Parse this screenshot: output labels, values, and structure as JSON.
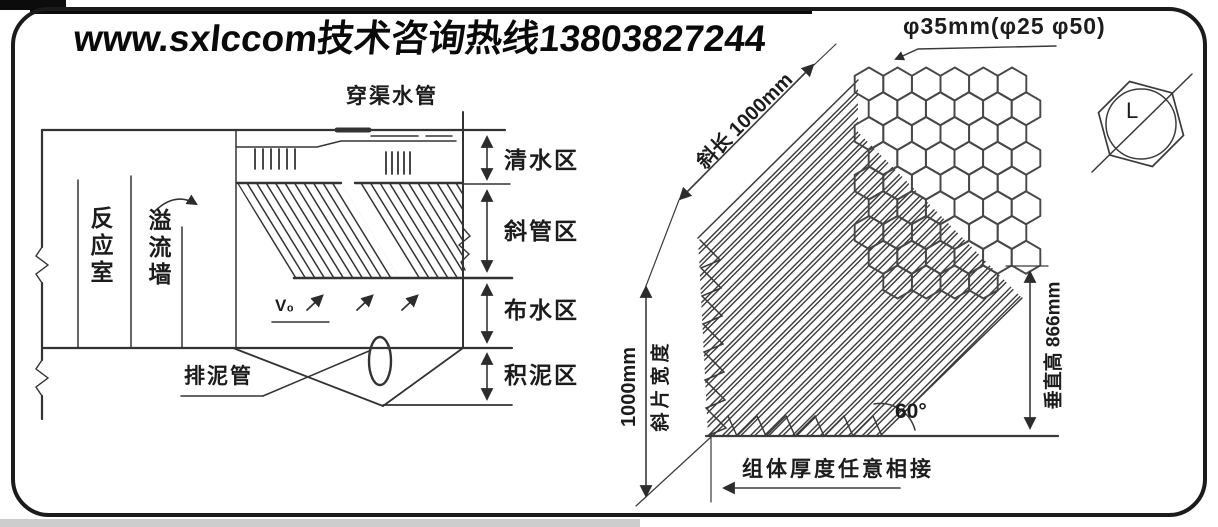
{
  "header": {
    "hotline_text": "www.sxlccom技术咨询热线13803827244"
  },
  "tank": {
    "pipe_label": "穿渠水管",
    "reaction_chamber_label": "反应室",
    "overflow_wall_label": "溢流墙",
    "sludge_pipe_label": "排泥管",
    "velocity_label": "V₀",
    "zones": [
      {
        "label": "清水区"
      },
      {
        "label": "斜管区"
      },
      {
        "label": "布水区"
      },
      {
        "label": "积泥区"
      }
    ]
  },
  "module": {
    "diameter_label": "φ35mm(φ25 φ50)",
    "slope_length_label": "斜长 1000mm",
    "width_label": "1000mm",
    "sheet_width_label": "斜片宽度",
    "vertical_height_label": "垂直高 866mm",
    "angle_label": "60°",
    "joint_note": "组体厚度任意相接",
    "cell_dim_label": "L"
  }
}
